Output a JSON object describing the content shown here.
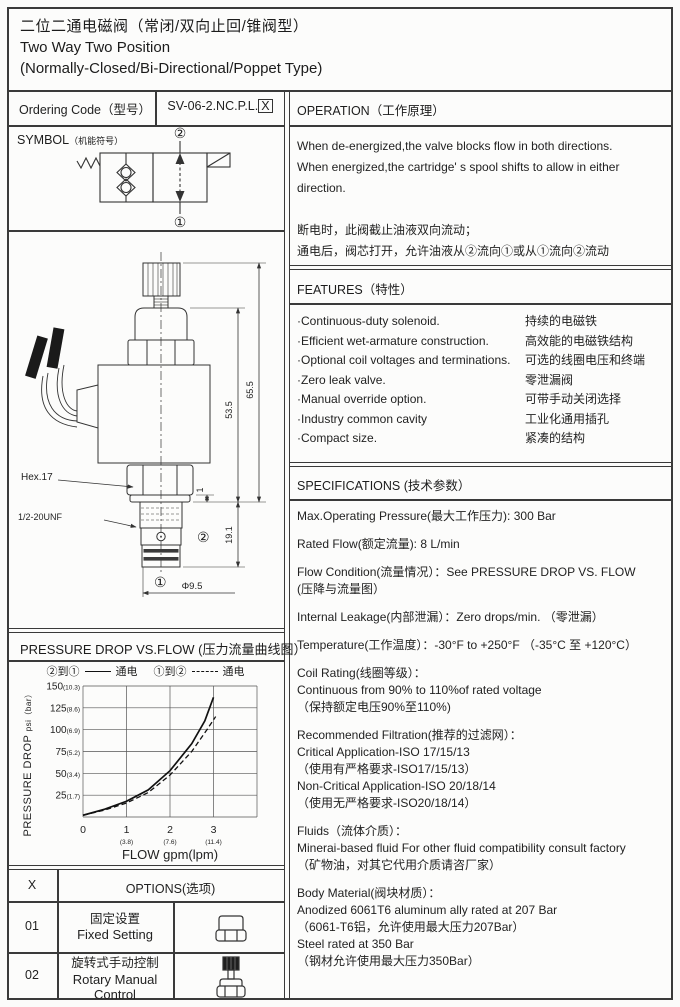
{
  "title": {
    "zh": "二位二通电磁阀（常闭/双向止回/锥阀型）",
    "en_line1": "Two Way Two Position",
    "en_line2": "(Normally-Closed/Bi-Directional/Poppet Type)"
  },
  "ordering": {
    "label": "Ordering Code（型号）",
    "code": "SV-06-2.NC.P.L.",
    "code_suffix": "X"
  },
  "symbol_section": {
    "header_main": "SYMBOL",
    "header_sub": "（机能符号）",
    "port_top": "②",
    "port_bottom": "①"
  },
  "drawing": {
    "hex_label": "Hex.17",
    "thread_label": "1/2-20UNF",
    "dim_height_outer": "65.5",
    "dim_height_inner": "53.5",
    "dim_nose": "19.1",
    "dim_washer": "1",
    "dim_diameter": "Φ9.5",
    "port2": "②",
    "port1": "①"
  },
  "operation": {
    "header": "OPERATION（工作原理）",
    "lines": [
      "When de-energized,the valve blocks flow in both directions.",
      "When energized,the cartridge' s spool shifts to allow in either",
      "direction.",
      "",
      "断电时，此阀截止油液双向流动；",
      "通电后，阀芯打开，允许油液从②流向①或从①流向②流动"
    ]
  },
  "features": {
    "header": "FEATURES（特性）",
    "items": [
      {
        "en": "·Continuous-duty  solenoid.",
        "zh": "持续的电磁铁"
      },
      {
        "en": "·Efficient wet-armature construction.",
        "zh": "高效能的电磁铁结构"
      },
      {
        "en": "·Optional coil voltages and terminations.",
        "zh": "可选的线圈电压和终端"
      },
      {
        "en": "·Zero leak valve.",
        "zh": "零泄漏阀"
      },
      {
        "en": "·Manual override option.",
        "zh": "可带手动关闭选择"
      },
      {
        "en": "·Industry common cavity",
        "zh": "工业化通用插孔"
      },
      {
        "en": "·Compact size.",
        "zh": "紧凑的结构"
      }
    ]
  },
  "specifications": {
    "header": "SPECIFICATIONS (技术参数）",
    "paragraphs": [
      [
        "Max.Operating Pressure(最大工作压力): 300 Bar"
      ],
      [
        "Rated Flow(额定流量): 8 L/min"
      ],
      [
        "Flow Condition(流量情况）：See PRESSURE DROP VS. FLOW",
        "(压降与流量图）"
      ],
      [
        "Internal Leakage(内部泄漏）：Zero drops/min. （零泄漏）"
      ],
      [
        "Temperature(工作温度）：-30°F to +250°F  （-35°C 至 +120°C）"
      ],
      [
        "Coil Rating(线圈等级）：",
        "Continuous from 90% to 110%of rated voltage",
        "（保持额定电压90%至110%)"
      ],
      [
        "Recommended Filtration(推荐的过滤网）：",
        "Critical Application-ISO 17/15/13",
        "（使用有严格要求-ISO17/15/13）",
        "Non-Critical Application-ISO 20/18/14",
        "（使用无严格要求-ISO20/18/14）"
      ],
      [
        "Fluids（流体介质）：",
        "Minerai-based fluid For other  fluid compatibility consult  factory",
        "（矿物油，对其它代用介质请咨厂家）"
      ],
      [
        "Body Material(阀块材质）：",
        "Anodized 6061T6 aluminum ally rated at 207 Bar",
        "（6061-T6铝，允许使用最大压力207Bar）",
        "Steel rated at 350 Bar",
        "（钢材允许使用最大压力350Bar）"
      ]
    ]
  },
  "pressure_chart": {
    "header": "PRESSURE DROP VS.FLOW (压力流量曲线图）",
    "legend": [
      {
        "label": "②到①",
        "suffix": "通电",
        "style": "solid"
      },
      {
        "label": "①到②",
        "suffix": "通电",
        "style": "dashed"
      }
    ],
    "ylabel_main": "PRESSURE DROP",
    "ylabel_sub": "psi（bar）",
    "xlabel": "FLOW gpm(lpm)"
  },
  "chart_data": {
    "type": "line",
    "title": "PRESSURE DROP VS.FLOW (压力流量曲线图）",
    "xlabel": "FLOW gpm(lpm)",
    "ylabel": "PRESSURE DROP psi（bar）",
    "xlim": [
      0,
      4
    ],
    "ylim": [
      0,
      150
    ],
    "grid": true,
    "legend_position": "top",
    "xgrid": [
      0,
      1,
      2,
      3,
      4
    ],
    "ygrid": [
      0,
      25,
      50,
      75,
      100,
      125,
      150
    ],
    "xticks": [
      {
        "x": 0,
        "gpm": "0",
        "lpm": ""
      },
      {
        "x": 1,
        "gpm": "1",
        "lpm": "(3.8)"
      },
      {
        "x": 2,
        "gpm": "2",
        "lpm": "(7.6)"
      },
      {
        "x": 3,
        "gpm": "3",
        "lpm": "(11.4)"
      }
    ],
    "yticks": [
      {
        "y": 25,
        "psi": "25",
        "bar": "(1.7)"
      },
      {
        "y": 50,
        "psi": "50",
        "bar": "(3.4)"
      },
      {
        "y": 75,
        "psi": "75",
        "bar": "(5.2)"
      },
      {
        "y": 100,
        "psi": "100",
        "bar": "(6.9)"
      },
      {
        "y": 125,
        "psi": "125",
        "bar": "(8.6)"
      },
      {
        "y": 150,
        "psi": "150",
        "bar": "(10.3)"
      }
    ],
    "series": [
      {
        "name": "②到① 通电",
        "dash": "solid",
        "points": [
          [
            0,
            2
          ],
          [
            0.5,
            9
          ],
          [
            1,
            18
          ],
          [
            1.5,
            31
          ],
          [
            2,
            53
          ],
          [
            2.5,
            84
          ],
          [
            2.8,
            110
          ],
          [
            3,
            137
          ]
        ]
      },
      {
        "name": "①到② 通电",
        "dash": "dashed",
        "points": [
          [
            0,
            2
          ],
          [
            0.5,
            8
          ],
          [
            1,
            16
          ],
          [
            1.5,
            28
          ],
          [
            2,
            48
          ],
          [
            2.5,
            75
          ],
          [
            2.85,
            100
          ],
          [
            3.05,
            115
          ]
        ]
      }
    ]
  },
  "options": {
    "col_x": "X",
    "col_options": "OPTIONS(选项)",
    "rows": [
      {
        "code": "01",
        "zh": "固定设置",
        "en": "Fixed Setting",
        "icon": "fixed-setting-icon"
      },
      {
        "code": "02",
        "zh": "旋转式手动控制",
        "en": "Rotary Manual Control",
        "icon": "rotary-manual-control-icon"
      }
    ]
  }
}
